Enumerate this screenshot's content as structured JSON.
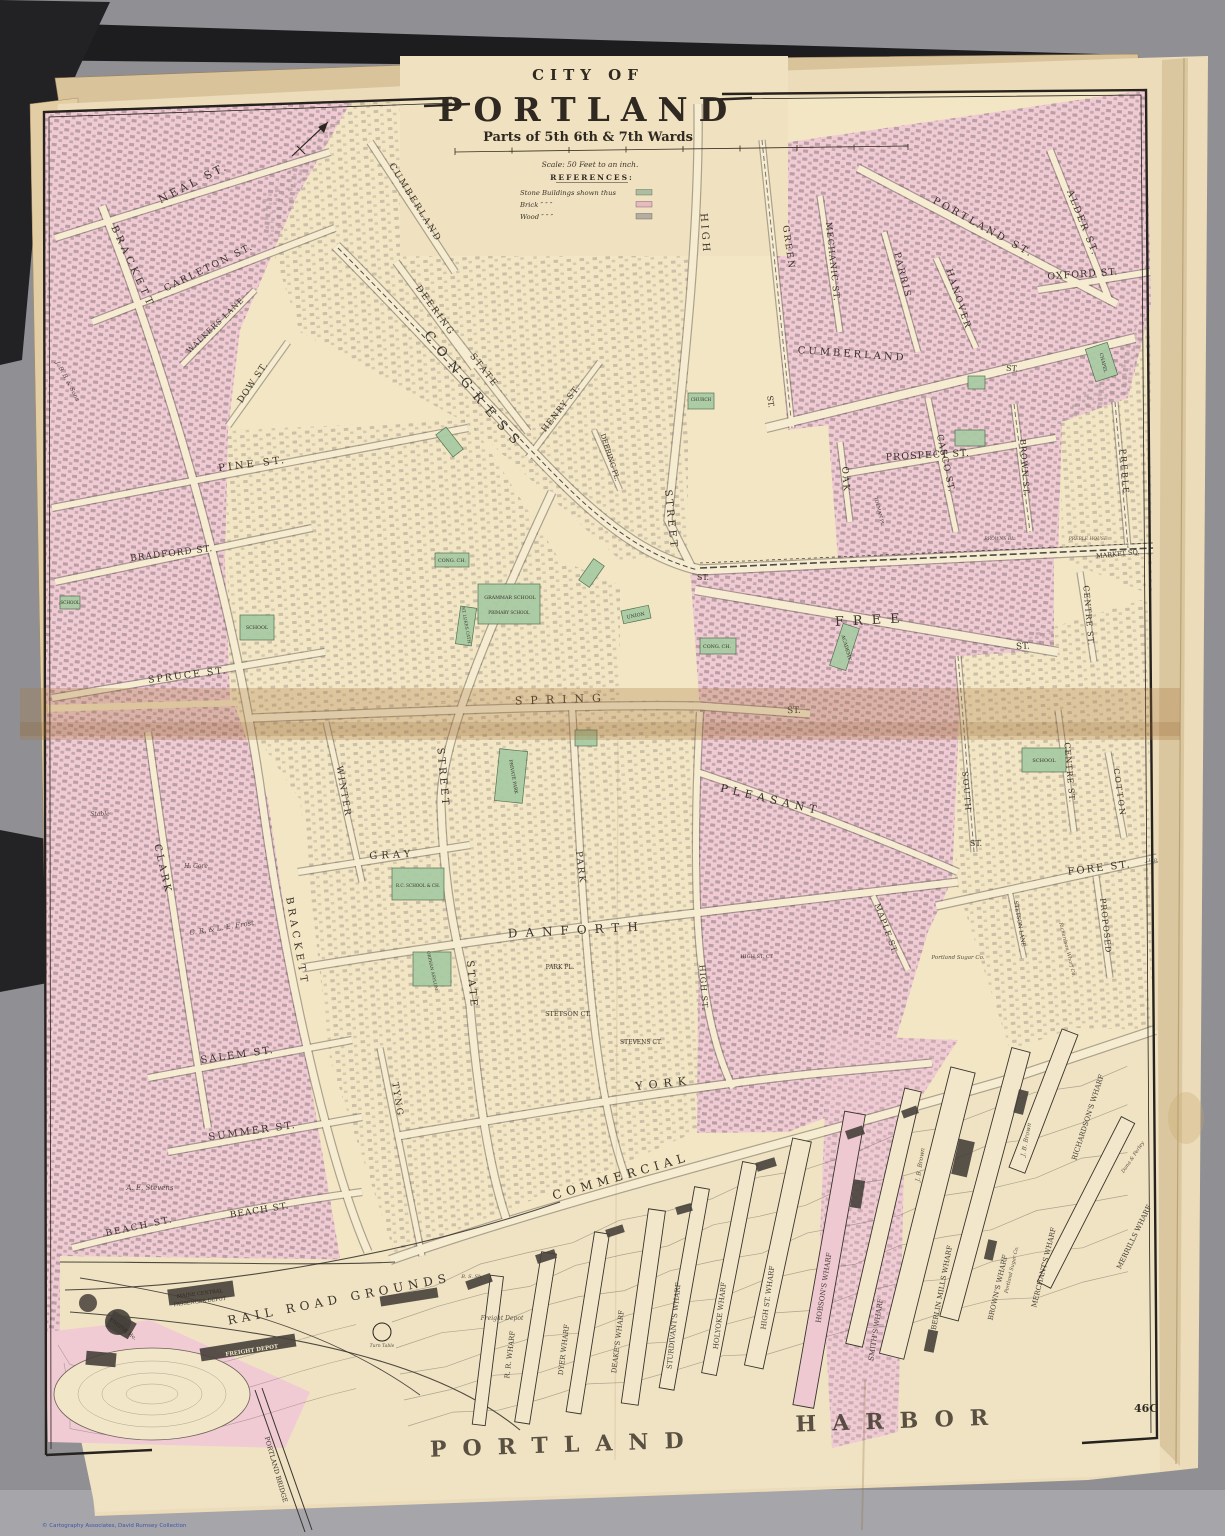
{
  "title": {
    "city_of": "CITY OF",
    "name": "PORTLAND",
    "subtitle": "Parts of 5th 6th & 7th Wards",
    "scale": "Scale: 50 Feet to an inch.",
    "references_heading": "REFERENCES:"
  },
  "legend": {
    "rows": [
      {
        "label": "Stone Buildings shown thus",
        "color": "#a9bfa0"
      },
      {
        "label": "Brick  ″          ″          ″",
        "color": "#e9b9c0"
      },
      {
        "label": "Wood  ″          ″          ″",
        "color": "#b5ada0"
      }
    ]
  },
  "page": {
    "number": "46C",
    "credit": "© Cartography Associates, David Rumsey Collection",
    "harbor_word1": "PORTLAND",
    "harbor_word2": "HARBOR"
  },
  "map": {
    "congress_label": "CONGRESS",
    "labels": [
      {
        "t": "NEAL ST.",
        "x": 195,
        "y": 186,
        "r": -27,
        "s": 11,
        "sp": 3
      },
      {
        "t": "BRACKETT",
        "x": 130,
        "y": 268,
        "r": 65,
        "s": 10,
        "sp": 4
      },
      {
        "t": "CARLETON ST.",
        "x": 210,
        "y": 270,
        "r": -26,
        "s": 9.5,
        "sp": 2
      },
      {
        "t": "WALKERS LANE",
        "x": 217,
        "y": 327,
        "r": -44,
        "s": 7.5,
        "sp": 1
      },
      {
        "t": "DOW ST.",
        "x": 255,
        "y": 384,
        "r": -56,
        "s": 9,
        "sp": 1
      },
      {
        "t": "J. B. B. & Sons",
        "x": 66,
        "y": 382,
        "r": 62,
        "s": 6,
        "c": "it"
      },
      {
        "t": "PINE ST.",
        "x": 253,
        "y": 467,
        "r": -7,
        "s": 10,
        "sp": 3
      },
      {
        "t": "BRADFORD ST.",
        "x": 172,
        "y": 556,
        "r": -7,
        "s": 9,
        "sp": 1
      },
      {
        "t": "SPRUCE ST.",
        "x": 188,
        "y": 678,
        "r": -7,
        "s": 9.5,
        "sp": 2
      },
      {
        "t": "CUMBERLAND",
        "x": 413,
        "y": 204,
        "r": 58,
        "s": 9,
        "sp": 2
      },
      {
        "t": "DEERING",
        "x": 433,
        "y": 312,
        "r": 54,
        "s": 9,
        "sp": 2
      },
      {
        "t": "STATE",
        "x": 482,
        "y": 372,
        "r": 52,
        "s": 9,
        "sp": 2
      },
      {
        "t": "HENRY ST.",
        "x": 563,
        "y": 410,
        "r": -52,
        "s": 8.5,
        "sp": 1
      },
      {
        "t": "DEERING PL.",
        "x": 608,
        "y": 458,
        "r": 72,
        "s": 7
      },
      {
        "t": "ST.",
        "x": 703,
        "y": 580,
        "s": 8
      },
      {
        "t": "HIGH",
        "x": 702,
        "y": 234,
        "r": 86,
        "s": 10,
        "sp": 3
      },
      {
        "t": "STREET",
        "x": 668,
        "y": 520,
        "r": 84,
        "s": 10,
        "sp": 3
      },
      {
        "t": "GREEN",
        "x": 786,
        "y": 248,
        "r": 82,
        "s": 9,
        "sp": 2
      },
      {
        "t": "ST.",
        "x": 768,
        "y": 402,
        "r": 82,
        "s": 8
      },
      {
        "t": "MECHANIC ST.",
        "x": 830,
        "y": 262,
        "r": 84,
        "s": 8.5,
        "sp": 1
      },
      {
        "t": "PARRIS",
        "x": 900,
        "y": 276,
        "r": 76,
        "s": 9,
        "sp": 2
      },
      {
        "t": "HANOVER",
        "x": 956,
        "y": 300,
        "r": 72,
        "s": 9,
        "sp": 2
      },
      {
        "t": "ALDER ST.",
        "x": 1080,
        "y": 224,
        "r": 68,
        "s": 9.5,
        "sp": 2
      },
      {
        "t": "PORTLAND ST.",
        "x": 982,
        "y": 230,
        "r": 29,
        "s": 10,
        "sp": 3
      },
      {
        "t": "OXFORD ST.",
        "x": 1083,
        "y": 277,
        "r": -4,
        "s": 9.5,
        "sp": 1
      },
      {
        "t": "CUMBERLAND",
        "x": 852,
        "y": 357,
        "r": 4,
        "s": 10,
        "sp": 3
      },
      {
        "t": "ST.",
        "x": 1012,
        "y": 371,
        "r": 4,
        "s": 8
      },
      {
        "t": "PROSPECT ST.",
        "x": 928,
        "y": 458,
        "r": -3,
        "s": 9.5,
        "sp": 1
      },
      {
        "t": "OAK",
        "x": 843,
        "y": 480,
        "r": 86,
        "s": 9,
        "sp": 2
      },
      {
        "t": "CASCO ST.",
        "x": 943,
        "y": 464,
        "r": 78,
        "s": 9,
        "sp": 1
      },
      {
        "t": "BROWN ST.",
        "x": 1022,
        "y": 468,
        "r": 86,
        "s": 8,
        "sp": 1
      },
      {
        "t": "PREBLE",
        "x": 1122,
        "y": 472,
        "r": 86,
        "s": 8,
        "sp": 2
      },
      {
        "t": "TOLMAN PL.",
        "x": 878,
        "y": 512,
        "r": 76,
        "s": 4.5
      },
      {
        "t": "BROWNS BL.",
        "x": 1000,
        "y": 540,
        "s": 4.5,
        "c": "it"
      },
      {
        "t": "PREBLE HOUSE",
        "x": 1088,
        "y": 540,
        "s": 4.5,
        "c": "it"
      },
      {
        "t": "MARKET SQ.",
        "x": 1118,
        "y": 556,
        "r": -6,
        "s": 6.5
      },
      {
        "t": "CHAPEL",
        "x": 1102,
        "y": 363,
        "r": 76,
        "s": 4.5
      },
      {
        "t": "SCHOOL",
        "x": 257,
        "y": 629,
        "s": 4.8
      },
      {
        "t": "SCHOOL",
        "x": 70,
        "y": 604,
        "s": 4.2
      },
      {
        "t": "CONG. CH.",
        "x": 452,
        "y": 562,
        "s": 4.8
      },
      {
        "t": "GRAMMAR SCHOOL",
        "x": 510,
        "y": 599,
        "s": 4.8
      },
      {
        "t": "PRIMARY SCHOOL",
        "x": 509,
        "y": 614,
        "s": 4.2
      },
      {
        "t": "ST. LUKES CATH.",
        "x": 465,
        "y": 626,
        "r": 80,
        "s": 4.2
      },
      {
        "t": "UNION",
        "x": 636,
        "y": 617,
        "r": -12,
        "s": 4.8
      },
      {
        "t": "CHURCH",
        "x": 701,
        "y": 401,
        "s": 4.2
      },
      {
        "t": "CONG. CH.",
        "x": 717,
        "y": 648,
        "s": 4.8
      },
      {
        "t": "ACADEMY",
        "x": 845,
        "y": 648,
        "r": 74,
        "s": 4.8
      },
      {
        "t": "FREE",
        "x": 872,
        "y": 624,
        "r": -3,
        "s": 13,
        "sp": 9
      },
      {
        "t": "ST.",
        "x": 1023,
        "y": 649,
        "r": -3,
        "s": 9
      },
      {
        "t": "SPRING",
        "x": 562,
        "y": 703,
        "r": -2,
        "s": 11,
        "sp": 8
      },
      {
        "t": "ST.",
        "x": 794,
        "y": 713,
        "r": -2,
        "s": 9
      },
      {
        "t": "CLARK",
        "x": 160,
        "y": 870,
        "r": 77,
        "s": 10,
        "sp": 3
      },
      {
        "t": "Stable",
        "x": 100,
        "y": 816,
        "s": 6,
        "c": "it"
      },
      {
        "t": "H. Gore",
        "x": 196,
        "y": 868,
        "s": 6,
        "c": "it"
      },
      {
        "t": "C. R. & L. E. Frost",
        "x": 222,
        "y": 930,
        "r": -9,
        "s": 7,
        "c": "it"
      },
      {
        "t": "BRACKETT",
        "x": 294,
        "y": 942,
        "r": 80,
        "s": 10,
        "sp": 4
      },
      {
        "t": "WINTER",
        "x": 341,
        "y": 792,
        "r": 80,
        "s": 9,
        "sp": 2
      },
      {
        "t": "GRAY",
        "x": 392,
        "y": 858,
        "r": -3,
        "s": 10,
        "sp": 4
      },
      {
        "t": "STREET",
        "x": 440,
        "y": 778,
        "r": 85,
        "s": 10,
        "sp": 3
      },
      {
        "t": "STATE",
        "x": 469,
        "y": 985,
        "r": 85,
        "s": 10,
        "sp": 3
      },
      {
        "t": "PARK",
        "x": 578,
        "y": 868,
        "r": 83,
        "s": 9,
        "sp": 2
      },
      {
        "t": "DANFORTH",
        "x": 577,
        "y": 934,
        "r": -3,
        "s": 12,
        "sp": 8
      },
      {
        "t": "PRIVATE PARK",
        "x": 512,
        "y": 777,
        "r": 80,
        "s": 4.5
      },
      {
        "t": "R.C. SCHOOL & CH.",
        "x": 418,
        "y": 887,
        "s": 4.2
      },
      {
        "t": "ORPHAN ASYLUM",
        "x": 431,
        "y": 971,
        "r": 78,
        "s": 4.2
      },
      {
        "t": "PARK PL.",
        "x": 560,
        "y": 969,
        "s": 6
      },
      {
        "t": "STETSON CT.",
        "x": 568,
        "y": 1016,
        "s": 6.5
      },
      {
        "t": "STEVENS CT.",
        "x": 641,
        "y": 1044,
        "s": 6
      },
      {
        "t": "PLEASANT",
        "x": 770,
        "y": 803,
        "r": 13,
        "s": 11,
        "sp": 5
      },
      {
        "t": "ST.",
        "x": 976,
        "y": 846,
        "s": 8
      },
      {
        "t": "SOUTH",
        "x": 964,
        "y": 792,
        "r": 85,
        "s": 8,
        "sp": 2
      },
      {
        "t": "HIGH ST.",
        "x": 701,
        "y": 988,
        "r": 86,
        "s": 8,
        "sp": 1
      },
      {
        "t": "HIGH ST. CT.",
        "x": 757,
        "y": 958,
        "s": 5
      },
      {
        "t": "MAPLE ST.",
        "x": 884,
        "y": 930,
        "r": 70,
        "s": 8,
        "sp": 1
      },
      {
        "t": "STETSON LANE",
        "x": 1018,
        "y": 924,
        "r": 80,
        "s": 5.5
      },
      {
        "t": "Portland Sugar Co.",
        "x": 958,
        "y": 959,
        "s": 5.5,
        "c": "it"
      },
      {
        "t": "PROPOSED",
        "x": 1103,
        "y": 926,
        "r": 84,
        "s": 8,
        "sp": 1
      },
      {
        "t": "Richardson Wharf Co.",
        "x": 1066,
        "y": 950,
        "r": 76,
        "s": 5,
        "c": "it"
      },
      {
        "t": "CENTRE ST.",
        "x": 1086,
        "y": 616,
        "r": 85,
        "s": 8,
        "sp": 1
      },
      {
        "t": "CENTRE ST.",
        "x": 1067,
        "y": 773,
        "r": 85,
        "s": 8,
        "sp": 1
      },
      {
        "t": "COTTON",
        "x": 1117,
        "y": 793,
        "r": 82,
        "s": 8,
        "sp": 2
      },
      {
        "t": "SCHOOL",
        "x": 1044,
        "y": 762,
        "s": 5
      },
      {
        "t": "FORE ST.",
        "x": 1100,
        "y": 871,
        "r": -7,
        "s": 10,
        "sp": 2
      },
      {
        "t": "J.H.B.",
        "x": 1152,
        "y": 862,
        "s": 4.5,
        "c": "it"
      },
      {
        "t": "SALEM ST.",
        "x": 238,
        "y": 1058,
        "r": -8,
        "s": 10,
        "sp": 2
      },
      {
        "t": "SUMMER ST.",
        "x": 253,
        "y": 1134,
        "r": -8,
        "s": 10,
        "sp": 2
      },
      {
        "t": "BEACH ST.",
        "x": 140,
        "y": 1229,
        "r": -12,
        "s": 9,
        "sp": 2
      },
      {
        "t": "BEACH ST.",
        "x": 260,
        "y": 1213,
        "r": -9,
        "s": 9,
        "sp": 1
      },
      {
        "t": "A. E. Stevens",
        "x": 150,
        "y": 1190,
        "s": 7,
        "c": "it"
      },
      {
        "t": "TYNG",
        "x": 395,
        "y": 1100,
        "r": 81,
        "s": 9,
        "sp": 2
      },
      {
        "t": "YORK",
        "x": 664,
        "y": 1087,
        "r": -6,
        "s": 11,
        "sp": 6
      },
      {
        "t": "COMMERCIAL",
        "x": 622,
        "y": 1180,
        "r": -16,
        "s": 12,
        "sp": 5
      },
      {
        "t": "MAINE CENTRAL",
        "x": 200,
        "y": 1295,
        "r": -7,
        "s": 5
      },
      {
        "t": "PASSENGER DEPOT",
        "x": 200,
        "y": 1303,
        "r": -7,
        "s": 5
      },
      {
        "t": "ENGINE Ho.",
        "x": 122,
        "y": 1330,
        "r": 38,
        "s": 5
      },
      {
        "t": "FREIGHT DEPOT",
        "x": 252,
        "y": 1352,
        "r": -9,
        "s": 5.5,
        "c": "wt"
      },
      {
        "t": "Freight Depot",
        "x": 502,
        "y": 1320,
        "s": 6,
        "c": "it"
      },
      {
        "t": "Turn Table",
        "x": 382,
        "y": 1347,
        "s": 4.5,
        "c": "it"
      },
      {
        "t": "B. S. Sh.",
        "x": 472,
        "y": 1278,
        "s": 5,
        "c": "it"
      },
      {
        "t": "RAIL ROAD GROUNDS",
        "x": 340,
        "y": 1303,
        "r": -11,
        "s": 12,
        "sp": 5
      },
      {
        "t": "PORTLAND BRIDGE",
        "x": 274,
        "y": 1470,
        "r": 74,
        "s": 6.5
      },
      {
        "t": "R. R. WHARF",
        "x": 512,
        "y": 1355,
        "r": -83,
        "s": 7,
        "c": "wh"
      },
      {
        "t": "DYER WHARF",
        "x": 566,
        "y": 1350,
        "r": -83,
        "s": 7,
        "c": "wh"
      },
      {
        "t": "DEAKE'S WHARF",
        "x": 620,
        "y": 1342,
        "r": -83,
        "s": 7,
        "c": "wh"
      },
      {
        "t": "STURDIVANT'S WHARF",
        "x": 676,
        "y": 1326,
        "r": -84,
        "s": 7,
        "c": "wh"
      },
      {
        "t": "HOLYOKE WHARF",
        "x": 722,
        "y": 1316,
        "r": -83,
        "s": 7,
        "c": "wh"
      },
      {
        "t": "HIGH ST. WHARF",
        "x": 770,
        "y": 1298,
        "r": -82,
        "s": 7,
        "c": "wh"
      },
      {
        "t": "HOBSON'S WHARF",
        "x": 826,
        "y": 1288,
        "r": -81,
        "s": 7,
        "c": "wh"
      },
      {
        "t": "SMITH'S WHARF",
        "x": 878,
        "y": 1330,
        "r": -81,
        "s": 7,
        "c": "wh"
      },
      {
        "t": "BERLIN MILLS WHARF",
        "x": 944,
        "y": 1288,
        "r": -79,
        "s": 7,
        "c": "wh"
      },
      {
        "t": "BROWN'S WHARF",
        "x": 1000,
        "y": 1288,
        "r": -77,
        "s": 7,
        "c": "wh"
      },
      {
        "t": "Portland Sugar Co.",
        "x": 1013,
        "y": 1270,
        "r": -77,
        "s": 5,
        "c": "it"
      },
      {
        "t": "MERCHANT'S WHARF",
        "x": 1046,
        "y": 1268,
        "r": -76,
        "s": 7,
        "c": "wh"
      },
      {
        "t": "RICHARDSON'S WHARF",
        "x": 1090,
        "y": 1118,
        "r": -72,
        "s": 7,
        "c": "wh"
      },
      {
        "t": "MERRILLS WHARF",
        "x": 1136,
        "y": 1238,
        "r": -64,
        "s": 7,
        "c": "wh"
      },
      {
        "t": "J. B. Brown",
        "x": 1028,
        "y": 1140,
        "r": -79,
        "s": 6,
        "c": "it"
      },
      {
        "t": "J. B. Brown",
        "x": 922,
        "y": 1165,
        "r": -81,
        "s": 6,
        "c": "it"
      },
      {
        "t": "Dana & Perley",
        "x": 1134,
        "y": 1158,
        "r": -56,
        "s": 5,
        "c": "it"
      }
    ]
  }
}
